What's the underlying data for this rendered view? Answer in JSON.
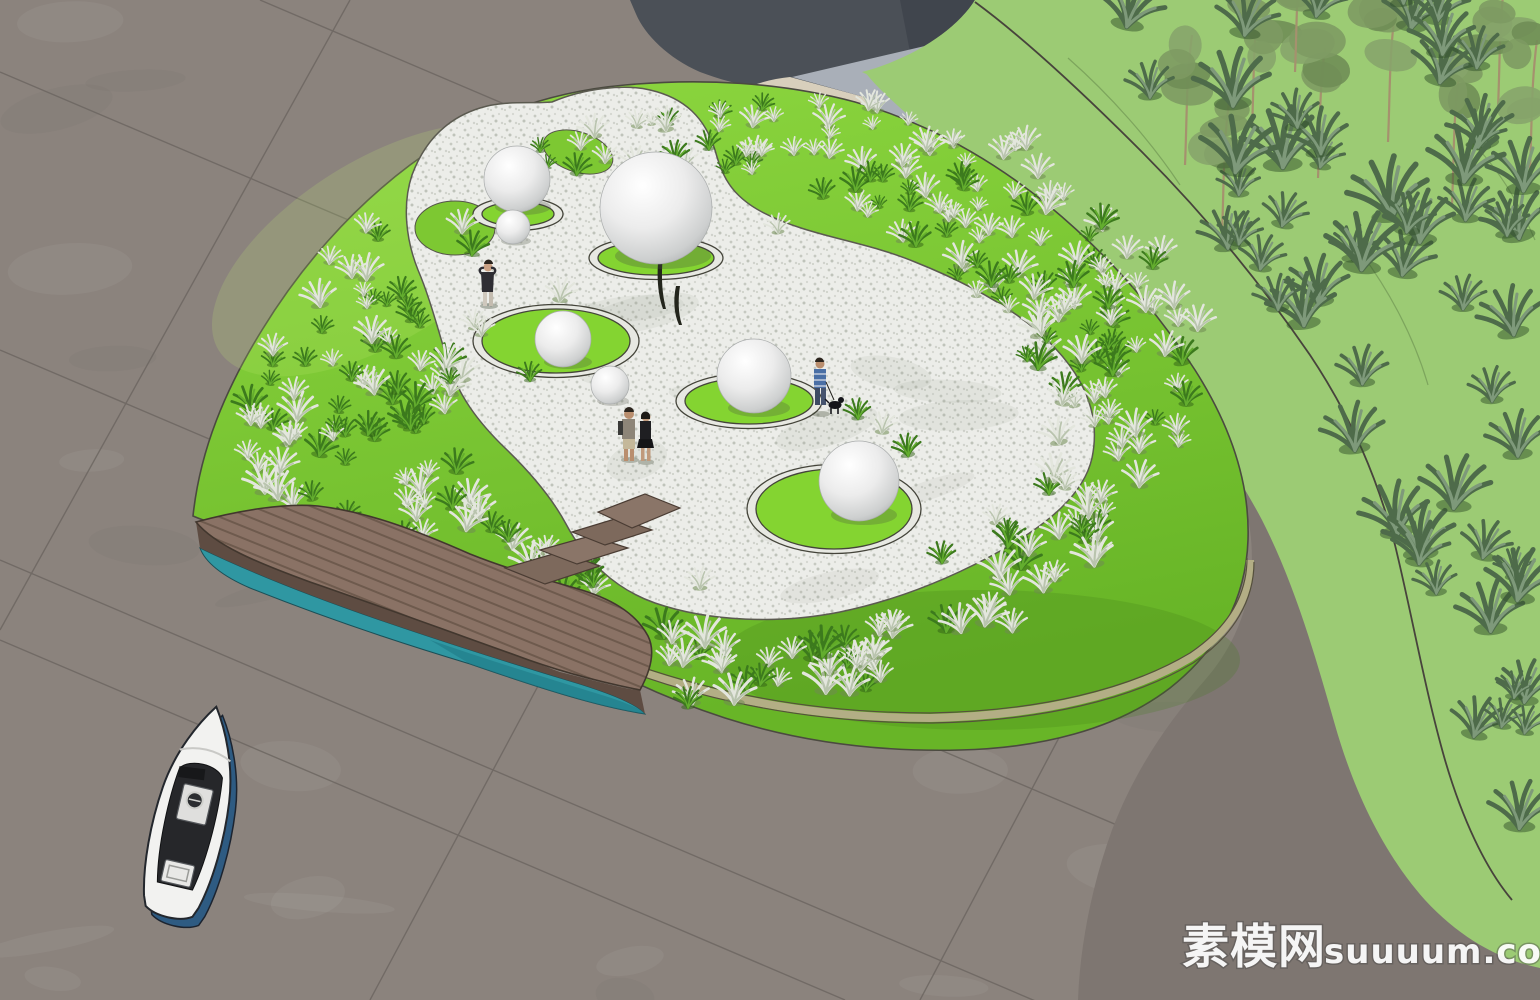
{
  "watermark": {
    "cjk": "素模网",
    "latin": "suuuum.com"
  },
  "scene": {
    "type": "3d-landscape-architecture-render",
    "description": "Aerial render of an oval planting island: silvery ornamental grass tufts on bright lawn mounds, a white gravel plaza with circular lawn pads and white ornament spheres, a wooden boardwalk with steps over a teal water channel, a small motorboat parked on the plaza paving, and a large lawn with blue-green grasses and trees at the upper right.",
    "counts": {
      "spheres": 7,
      "lawn_circles": 5,
      "people": 4,
      "dogs": 1,
      "boats": 1,
      "boardwalks": 1
    }
  },
  "colors": {
    "pavement": "#8b837d",
    "pavement_joint": "#6b6560",
    "dark_paving": "#4b5057",
    "dark_paving_deep": "#3e434b",
    "walkway_beige": "#d8cfbc",
    "paving_light_blue": "#a9afb8",
    "park_path": "#7e7671",
    "lawn": "#9ccb74",
    "lawn_edge_line": "#47433c",
    "island_grass": "#7dc832",
    "island_grass_dark": "#4d8d1c",
    "gravel": "#ebece8",
    "ring_green": "#84d431",
    "curb": "#b3ae85",
    "deck_wood": "#8a7265",
    "deck_side": "#5e4c42",
    "water": "#2f97a2",
    "water_dark": "#1f7a85",
    "boat_blue": "#2e5b82",
    "boat_white": "#f2f2f0",
    "sphere_edge": "#a9acac",
    "tuft_silver": "#e3e6dd",
    "tuft_green": "#3c7a1d",
    "lawn_clump": "#4e6b4a",
    "watermark": "#ffffff"
  }
}
